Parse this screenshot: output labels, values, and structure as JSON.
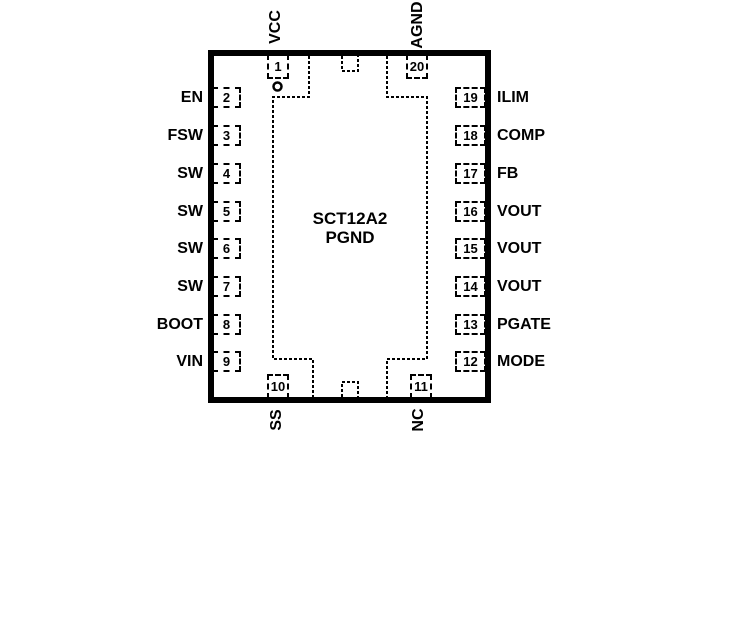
{
  "chip": {
    "part_number": "SCT12A2",
    "pad_label": "PGND"
  },
  "pins": {
    "left": [
      {
        "number": "2",
        "label": "EN"
      },
      {
        "number": "3",
        "label": "FSW"
      },
      {
        "number": "4",
        "label": "SW"
      },
      {
        "number": "5",
        "label": "SW"
      },
      {
        "number": "6",
        "label": "SW"
      },
      {
        "number": "7",
        "label": "SW"
      },
      {
        "number": "8",
        "label": "BOOT"
      },
      {
        "number": "9",
        "label": "VIN"
      }
    ],
    "right": [
      {
        "number": "19",
        "label": "ILIM"
      },
      {
        "number": "18",
        "label": "COMP"
      },
      {
        "number": "17",
        "label": "FB"
      },
      {
        "number": "16",
        "label": "VOUT"
      },
      {
        "number": "15",
        "label": "VOUT"
      },
      {
        "number": "14",
        "label": "VOUT"
      },
      {
        "number": "13",
        "label": "PGATE"
      },
      {
        "number": "12",
        "label": "MODE"
      }
    ],
    "top": [
      {
        "number": "1",
        "label": "VCC"
      },
      {
        "number": "20",
        "label": "AGND"
      }
    ],
    "bottom": [
      {
        "number": "10",
        "label": "SS"
      },
      {
        "number": "11",
        "label": "NC"
      }
    ]
  },
  "colors": {
    "line": "#000000",
    "background": "#ffffff"
  }
}
